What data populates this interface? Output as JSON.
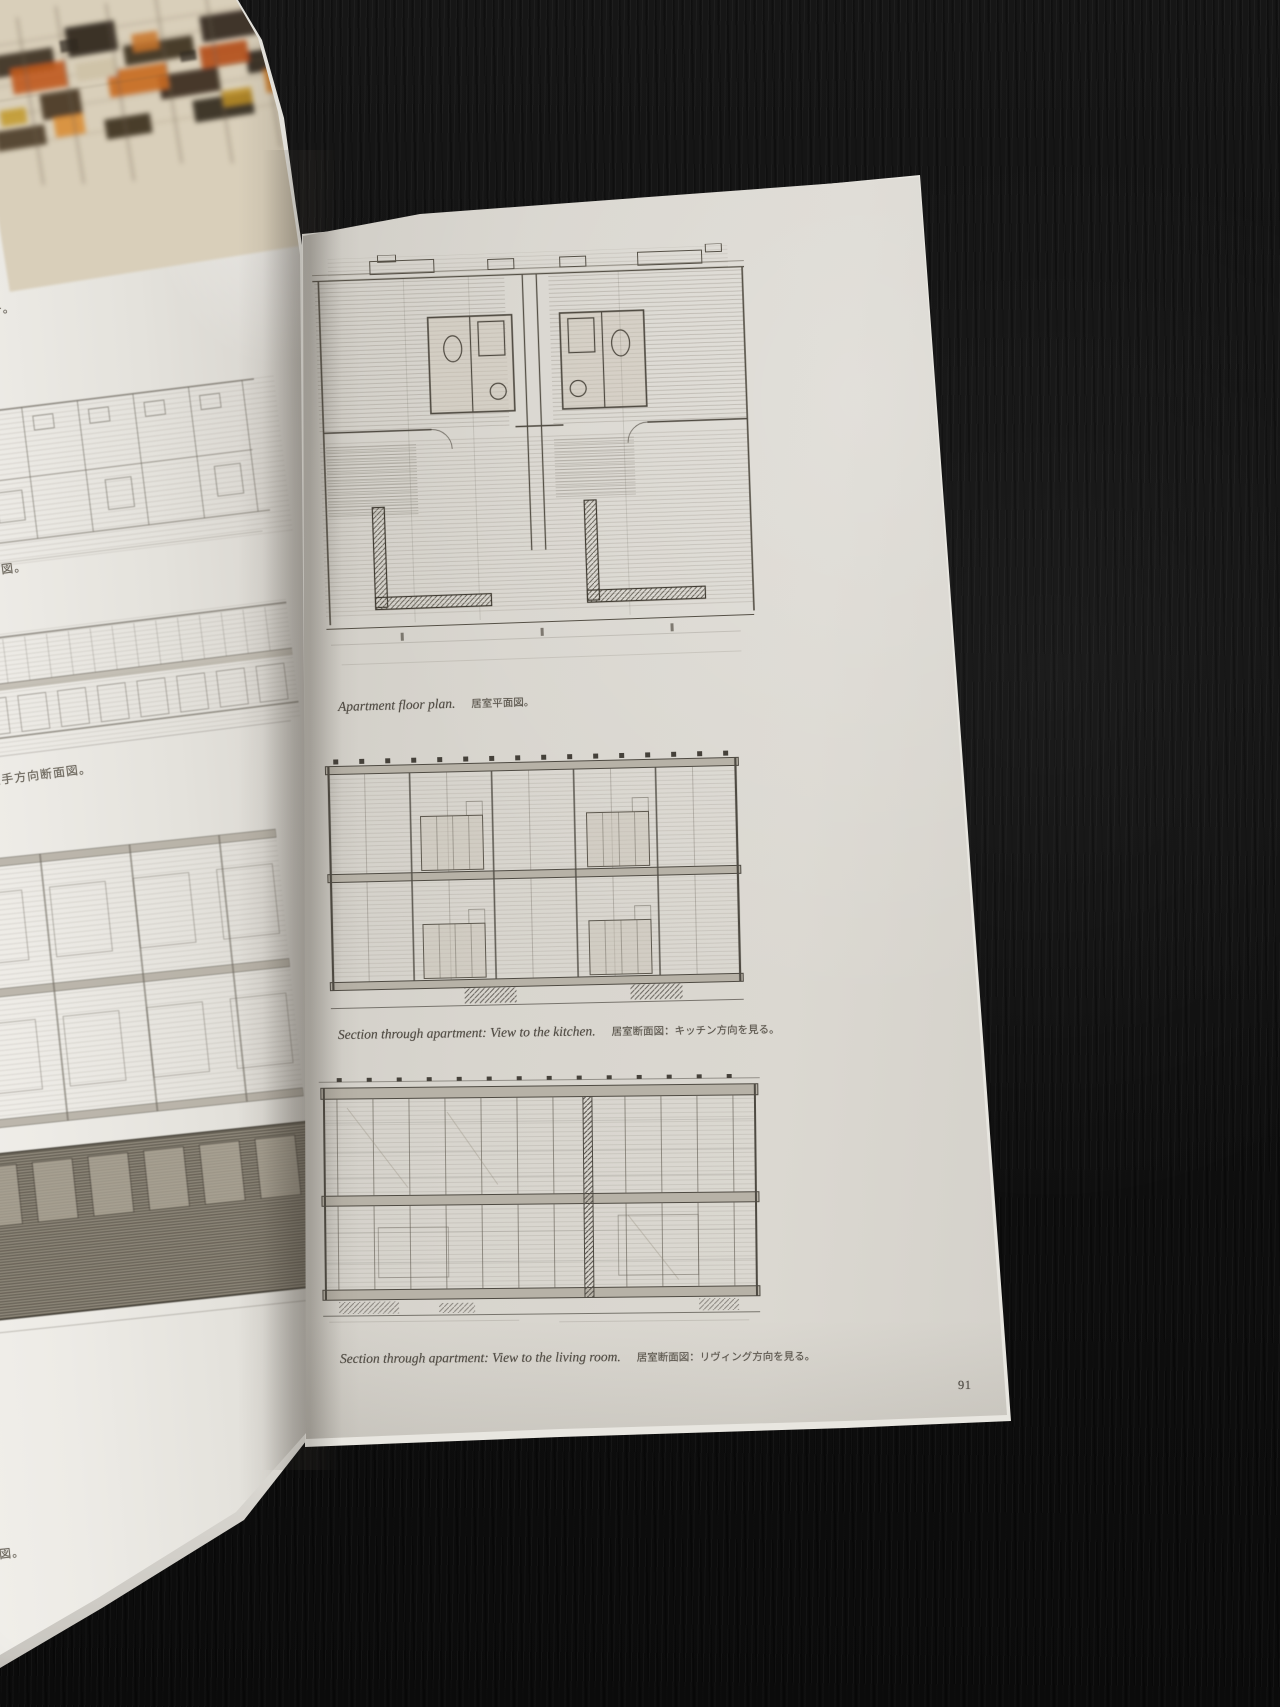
{
  "book": {
    "right_page": {
      "captions": [
        {
          "en": "Apartment floor plan.",
          "jp": "居室平面図。"
        },
        {
          "en": "Section through apartment: View to the kitchen.",
          "jp": "居室断面図：キッチン方向を見る。"
        },
        {
          "en": "Section through apartment: View to the living room.",
          "jp": "居室断面図：リヴィング方向を見る。"
        }
      ],
      "page_number": "91",
      "drawings": [
        "apartment-floor-plan-sketch",
        "section-sketch-kitchen-view",
        "section-sketch-living-room-view"
      ]
    },
    "left_page": {
      "caption_fragments": [
        "チ。",
        "面図。",
        "長手方向断面図。",
        "面図。"
      ],
      "drawings": [
        "color-elevation-sketch",
        "plan-sketch",
        "long-section-sketch",
        "large-section-sketch"
      ]
    }
  },
  "colors": {
    "background": "#101010",
    "right_paper": "#d7d4cd",
    "left_paper": "#e9e7e1",
    "pencil_ink": "#555047",
    "artwork_paper": "#d9cfba",
    "artwork_orange": "#c05a1e",
    "artwork_dark_brown": "#3a3128",
    "artwork_ochre": "#c2992b"
  }
}
